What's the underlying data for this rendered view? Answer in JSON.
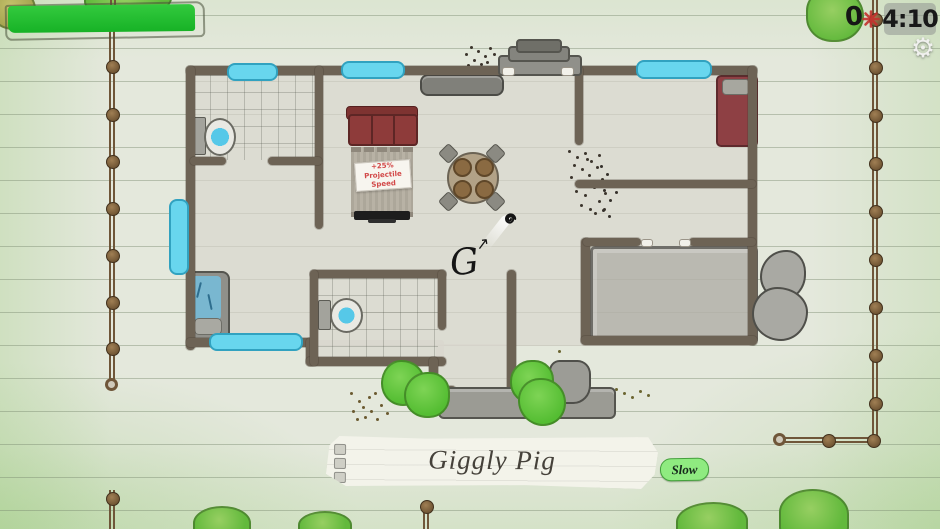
{
  "hud": {
    "score": {
      "value": "0"
    },
    "score_icon": {
      "name": "red-asterisk",
      "color": "#c5322e"
    },
    "timer": {
      "value": "4:10"
    },
    "settings": {
      "icon": "gear",
      "glyph": "⚙"
    }
  },
  "player": {
    "glyph": "G",
    "name": "Giggly Pig",
    "status": "Slow"
  },
  "pickup_tag": {
    "line1": "+25%",
    "line2": "Projectile Speed"
  },
  "colors": {
    "health_bar": "#22c336",
    "status_badge_bg": "#8feb80",
    "window_cyan": "#68d6ee",
    "couch_red": "#8e3b3a",
    "paper": "#e4e8dc"
  }
}
